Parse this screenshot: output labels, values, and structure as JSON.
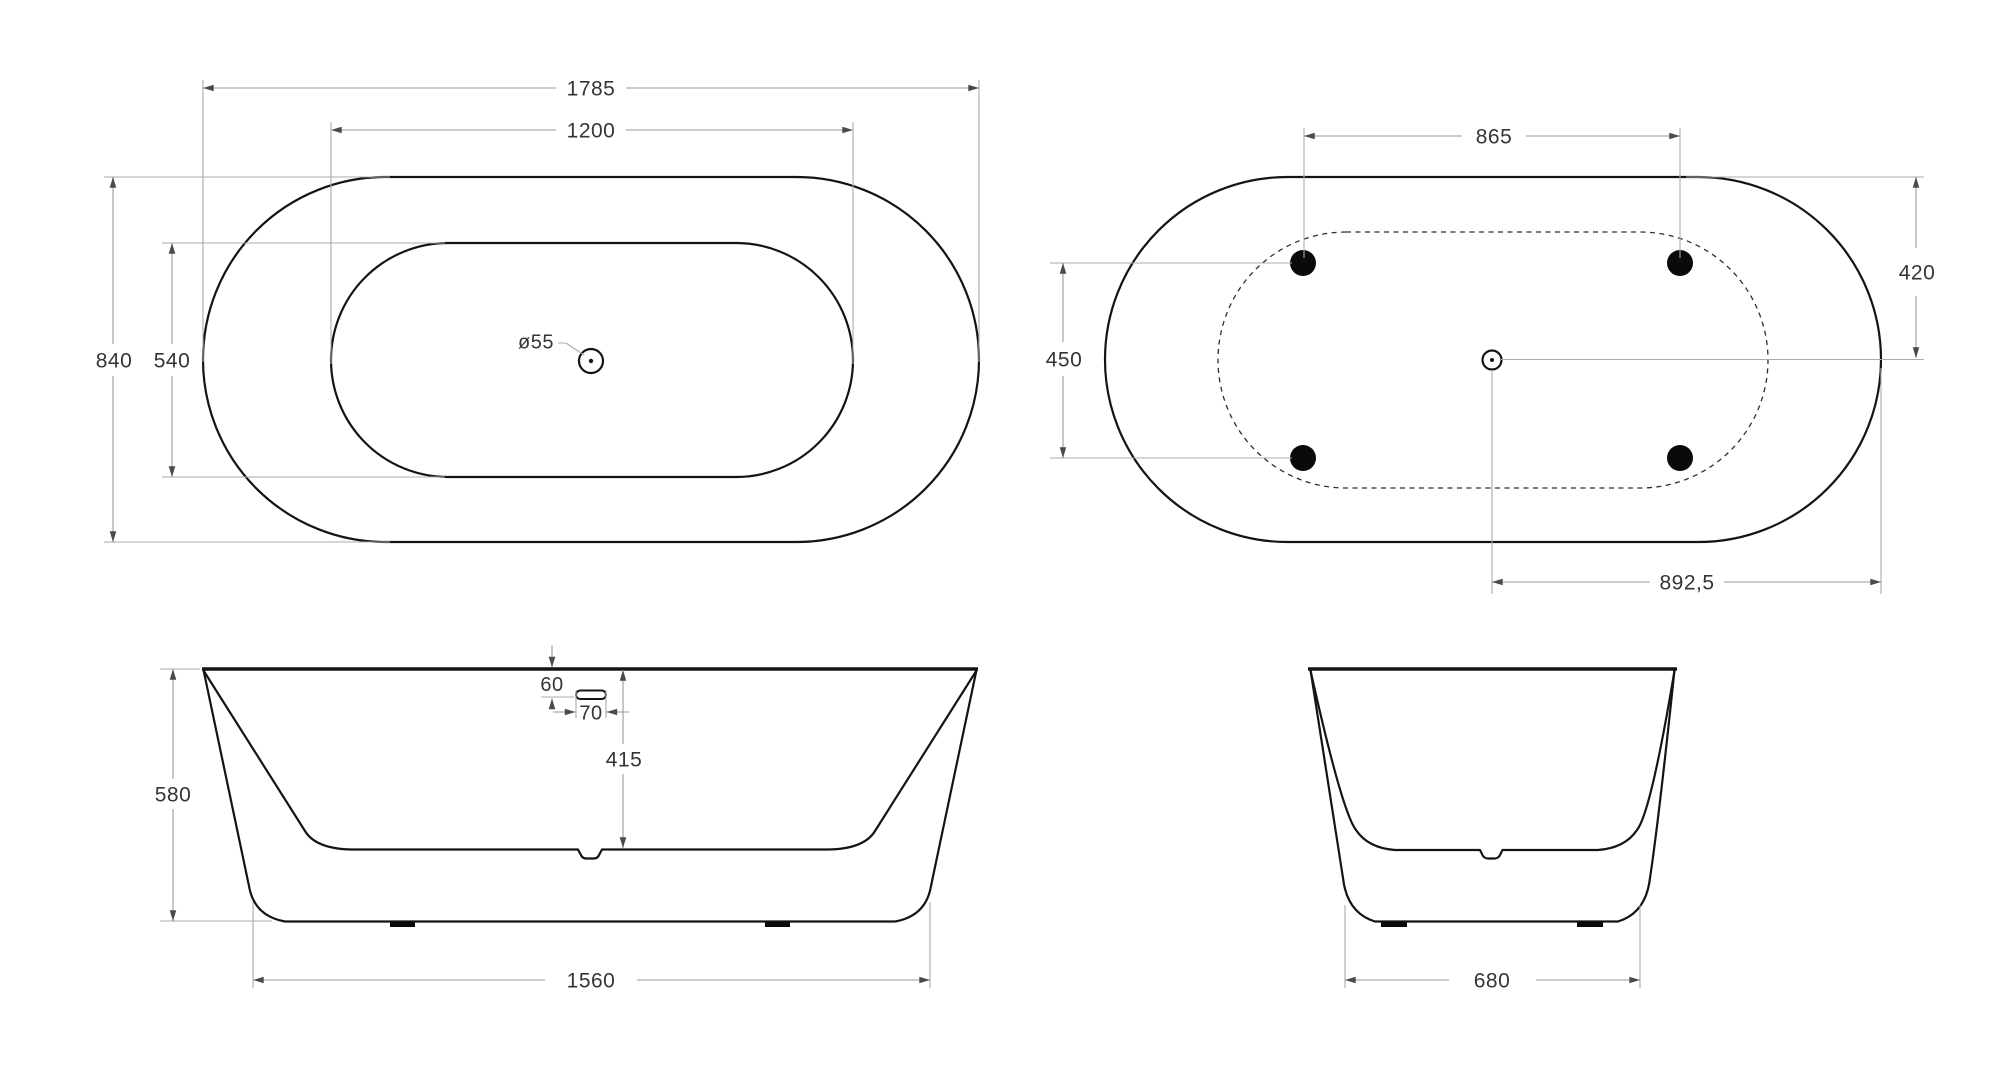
{
  "drawing": {
    "colors": {
      "background": "#ffffff",
      "outline": "#141414",
      "dimension_line": "#9a9a9a",
      "arrow": "#4a4a4a",
      "text": "#353535"
    },
    "views": {
      "plan_top": {
        "dims": {
          "overall_length": "1785",
          "inner_length": "1200",
          "overall_width": "840",
          "inner_width": "540",
          "drain_diameter": "ø55"
        }
      },
      "plan_bottom": {
        "dims": {
          "feet_span_length": "865",
          "feet_span_width": "450",
          "rim_to_center": "420",
          "center_to_end": "892,5"
        }
      },
      "side_elevation": {
        "dims": {
          "overall_height": "580",
          "overflow_drop": "60",
          "overflow_width": "70",
          "inner_depth": "415",
          "base_length": "1560"
        }
      },
      "end_elevation": {
        "dims": {
          "base_width": "680"
        }
      }
    }
  }
}
